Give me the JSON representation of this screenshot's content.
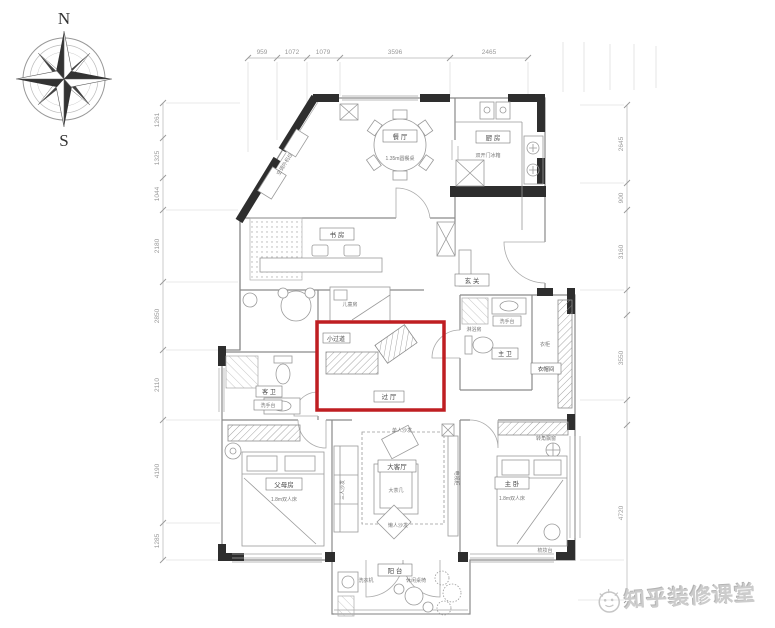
{
  "compass": {
    "north": "N",
    "south": "S"
  },
  "watermark": {
    "brand": "知乎装修课堂"
  },
  "colors": {
    "highlight": "#bf1e22",
    "structural_wall": "#2e2e2e",
    "line": "#8a8a8a"
  },
  "dimensions": {
    "top": [
      "959",
      "1072",
      "1079",
      "3596",
      "2465"
    ],
    "left": [
      "1261",
      "1325",
      "1044",
      "2180",
      "2850",
      "2110",
      "4190",
      "1285"
    ],
    "right": [
      "2645",
      "900",
      "3160",
      "3550",
      "4720"
    ]
  },
  "rooms": {
    "dining": {
      "name": "餐 厅",
      "note": "1.35m圆餐桌"
    },
    "kitchen": {
      "name": "厨 房",
      "fridge": "双开门冰箱"
    },
    "study": {
      "name": "书 房"
    },
    "kids": {
      "name": "儿童房"
    },
    "entry": {
      "name": "玄 关"
    },
    "corridor_small": {
      "name": "小过道"
    },
    "hall": {
      "name": "过 厅"
    },
    "guest_bath": {
      "name": "客 卫",
      "sink": "洗手台"
    },
    "master_bath": {
      "name": "主 卫",
      "sink": "洗手台",
      "shower": "淋浴房"
    },
    "cloak": {
      "name": "衣帽间",
      "wardrobe": "衣柜"
    },
    "parents": {
      "name": "父母房",
      "bed": "1.8m双人床"
    },
    "living": {
      "name": "大客厅",
      "table": "大茶几",
      "sofa3": "三人沙发",
      "sofa1": "单人沙发",
      "bean": "懒人沙发",
      "tv": "电视柜"
    },
    "master": {
      "name": "主 卧",
      "bed": "1.8m双人床",
      "bay": "转角飘窗",
      "vanity": "梳妆台"
    },
    "balcony": {
      "name": "阳 台",
      "washer": "洗衣机",
      "leisure": "休闲桌椅"
    },
    "ac": {
      "name": "空调外机位"
    }
  }
}
